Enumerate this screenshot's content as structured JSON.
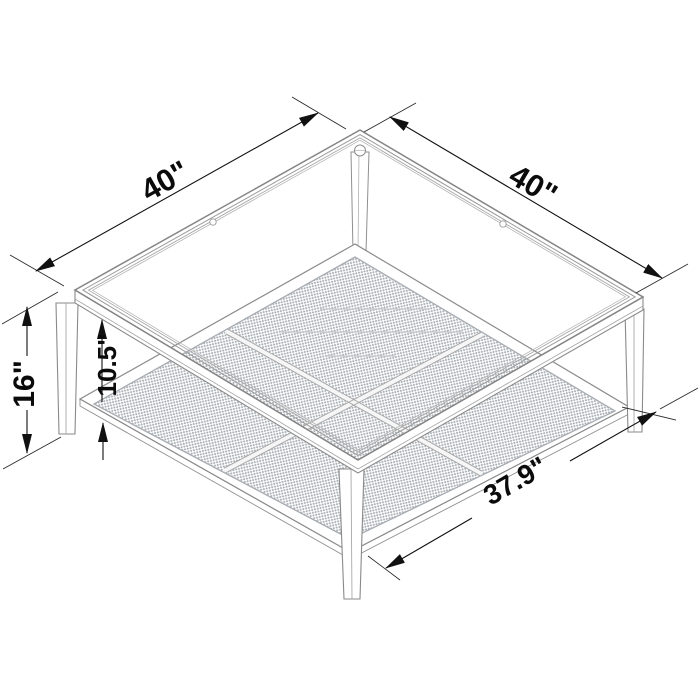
{
  "diagram": {
    "type": "furniture-dimension-diagram",
    "dimensions": {
      "top_left_edge": "40\"",
      "top_right_edge": "40\"",
      "overall_height": "16\"",
      "shelf_clearance": "10.5\"",
      "shelf_width": "37.9\""
    },
    "colors": {
      "background": "#ffffff",
      "structure_line": "#8a8a8a",
      "dimension_line": "#111111",
      "dimension_text": "#0b0b0b",
      "mesh_dot": "#aab0b6"
    }
  }
}
